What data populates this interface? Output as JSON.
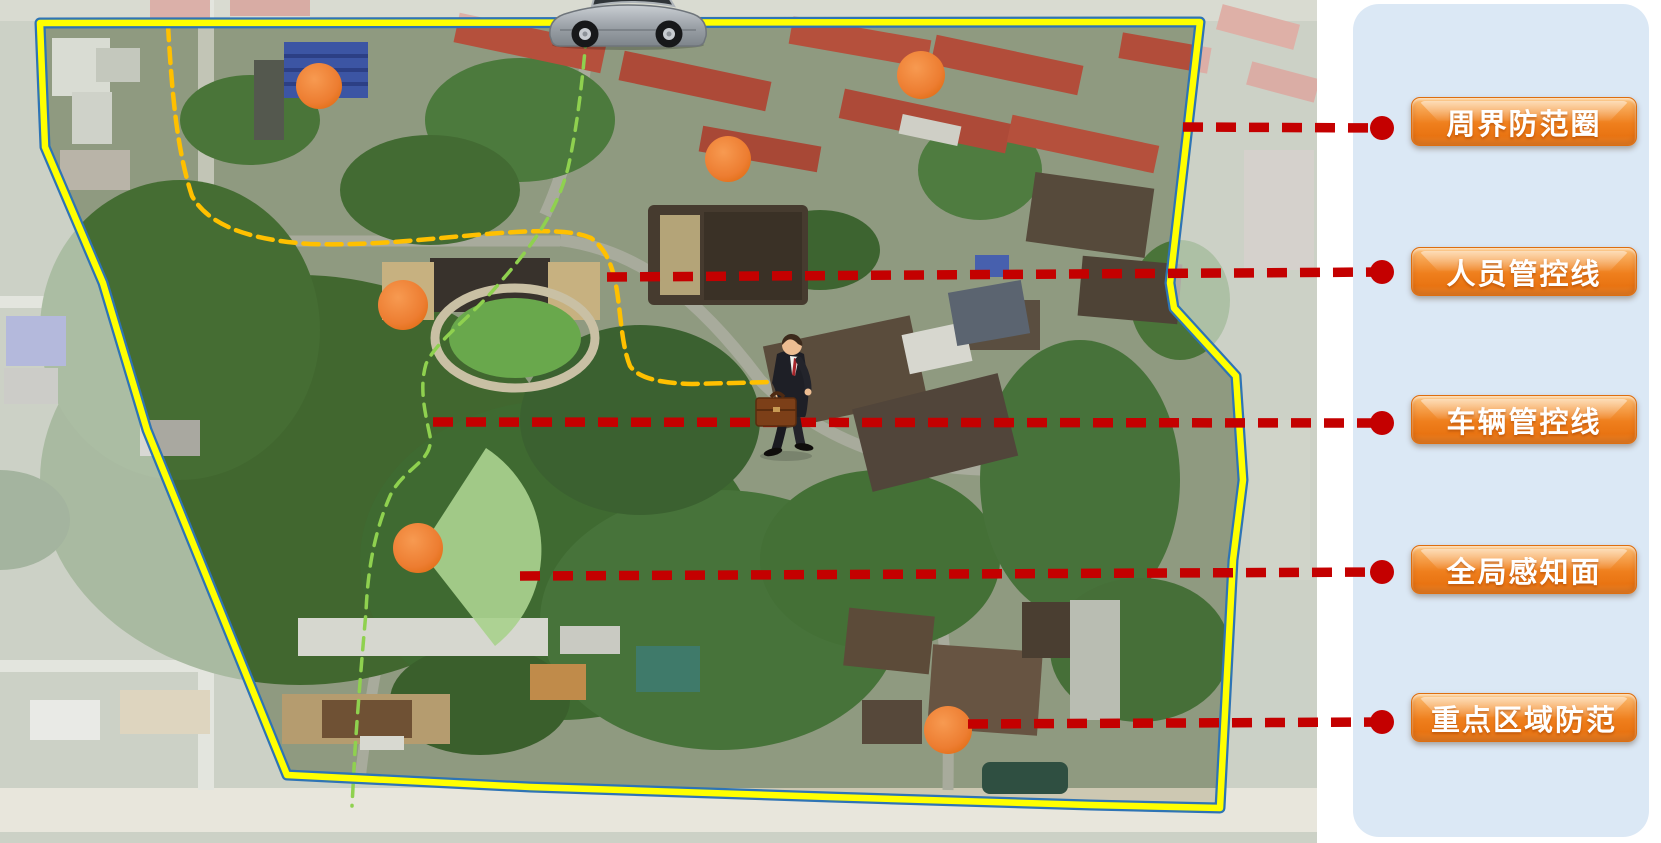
{
  "legend": {
    "panel_color": "#dbe8f5",
    "button_color": "#ef7f1d",
    "items": [
      {
        "id": "perimeter",
        "label": "周界防范圈"
      },
      {
        "id": "personnel",
        "label": "人员管控线"
      },
      {
        "id": "vehicle",
        "label": "车辆管控线"
      },
      {
        "id": "global",
        "label": "全局感知面"
      },
      {
        "id": "key-area",
        "label": "重点区域防范"
      }
    ]
  },
  "map": {
    "boundary": {
      "stroke": "#ffff00",
      "fringe": "#2e74b5",
      "points": [
        [
          40,
          23
        ],
        [
          1200,
          22
        ],
        [
          1170,
          283
        ],
        [
          1174,
          308
        ],
        [
          1236,
          376
        ],
        [
          1243,
          480
        ],
        [
          1233,
          560
        ],
        [
          1220,
          808
        ],
        [
          1090,
          805
        ],
        [
          830,
          797
        ],
        [
          530,
          787
        ],
        [
          287,
          775
        ],
        [
          147,
          430
        ],
        [
          103,
          283
        ],
        [
          45,
          147
        ]
      ]
    },
    "fade_opacity": 0.55,
    "routes": [
      {
        "id": "vehicle-patrol-route",
        "color": "#ffc000",
        "dash": "15 8",
        "width": 4.5,
        "d": "M168,25 C172,95 177,150 192,196 C209,226 250,240 310,244 C378,246 432,238 500,233 C543,230 572,230 591,238 C606,249 613,266 617,291 C621,318 622,346 630,366 C639,379 662,383 692,384 L772,382"
      },
      {
        "id": "person-patrol-route",
        "color": "#8fd14f",
        "dash": "12 9",
        "width": 3.5,
        "d": "M588,14 C584,68 578,124 568,168 C556,214 532,246 497,286 C467,321 437,340 426,364 C419,388 425,412 430,436 C434,462 403,468 390,496 C377,526 368,562 366,612 C362,656 358,706 355,750 L352,806"
      }
    ],
    "sensors": {
      "color": "#ed7d31",
      "points": [
        {
          "cx": 319,
          "cy": 86,
          "r": 23
        },
        {
          "cx": 921,
          "cy": 75,
          "r": 24
        },
        {
          "cx": 728,
          "cy": 159,
          "r": 23
        },
        {
          "cx": 403,
          "cy": 305,
          "r": 25
        },
        {
          "cx": 418,
          "cy": 548,
          "r": 25
        },
        {
          "cx": 948,
          "cy": 730,
          "r": 24
        }
      ]
    },
    "coverage_fan": {
      "color": "#a9d18e",
      "opacity": 0.92,
      "d": "M420,550 L486,448 A122,122 0 0 1 495,646 Z"
    },
    "connectors": {
      "color": "#c40000",
      "width": 9.5,
      "dash": "20 13",
      "dot_r": 12,
      "lines": [
        {
          "x1": 1183,
          "y1": 127,
          "x2": 1382,
          "y2": 128
        },
        {
          "x1": 607,
          "y1": 277,
          "x2": 1382,
          "y2": 272
        },
        {
          "x1": 433,
          "y1": 422,
          "x2": 1382,
          "y2": 423
        },
        {
          "x1": 520,
          "y1": 576,
          "x2": 1382,
          "y2": 572
        },
        {
          "x1": 968,
          "y1": 724,
          "x2": 1382,
          "y2": 722
        }
      ]
    }
  }
}
